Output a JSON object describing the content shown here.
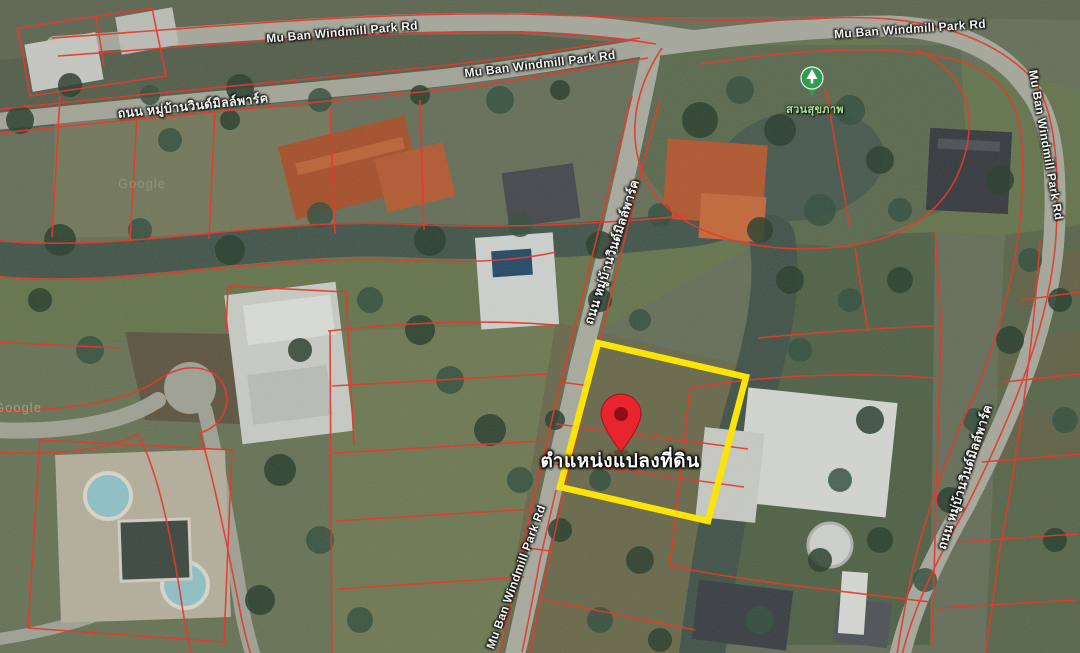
{
  "map": {
    "road_labels": [
      {
        "id": "top-left",
        "text": "Mu Ban Windmill Park Rd"
      },
      {
        "id": "top-center",
        "text": "Mu Ban Windmill Park Rd"
      },
      {
        "id": "top-right",
        "text": "Mu Ban Windmill Park Rd"
      },
      {
        "id": "right-edge",
        "text": "Mu Ban Windmill Park Rd"
      },
      {
        "id": "bottom-center",
        "text": "Mu Ban Windmill Park Rd"
      },
      {
        "id": "thai-top-left",
        "text": "ถนน หมู่บ้านวินด์มิลล์พาร์ค"
      },
      {
        "id": "thai-center-vertical",
        "text": "ถนน หมู่บ้านวินด์มิลล์พาร์ค"
      },
      {
        "id": "thai-right-vertical",
        "text": "ถนน หมู่บ้านวินด์มิลล์พาร์ค"
      }
    ],
    "poi": {
      "park_label": "สวนสุขภาพ"
    },
    "plot_marker": {
      "label": "ตำแหน่งแปลงที่ดิน",
      "pin_color": "#e8252e",
      "highlight_color": "#ffe600"
    },
    "overlay": {
      "parcel_line_color": "#e73529"
    },
    "watermark": "Google"
  }
}
